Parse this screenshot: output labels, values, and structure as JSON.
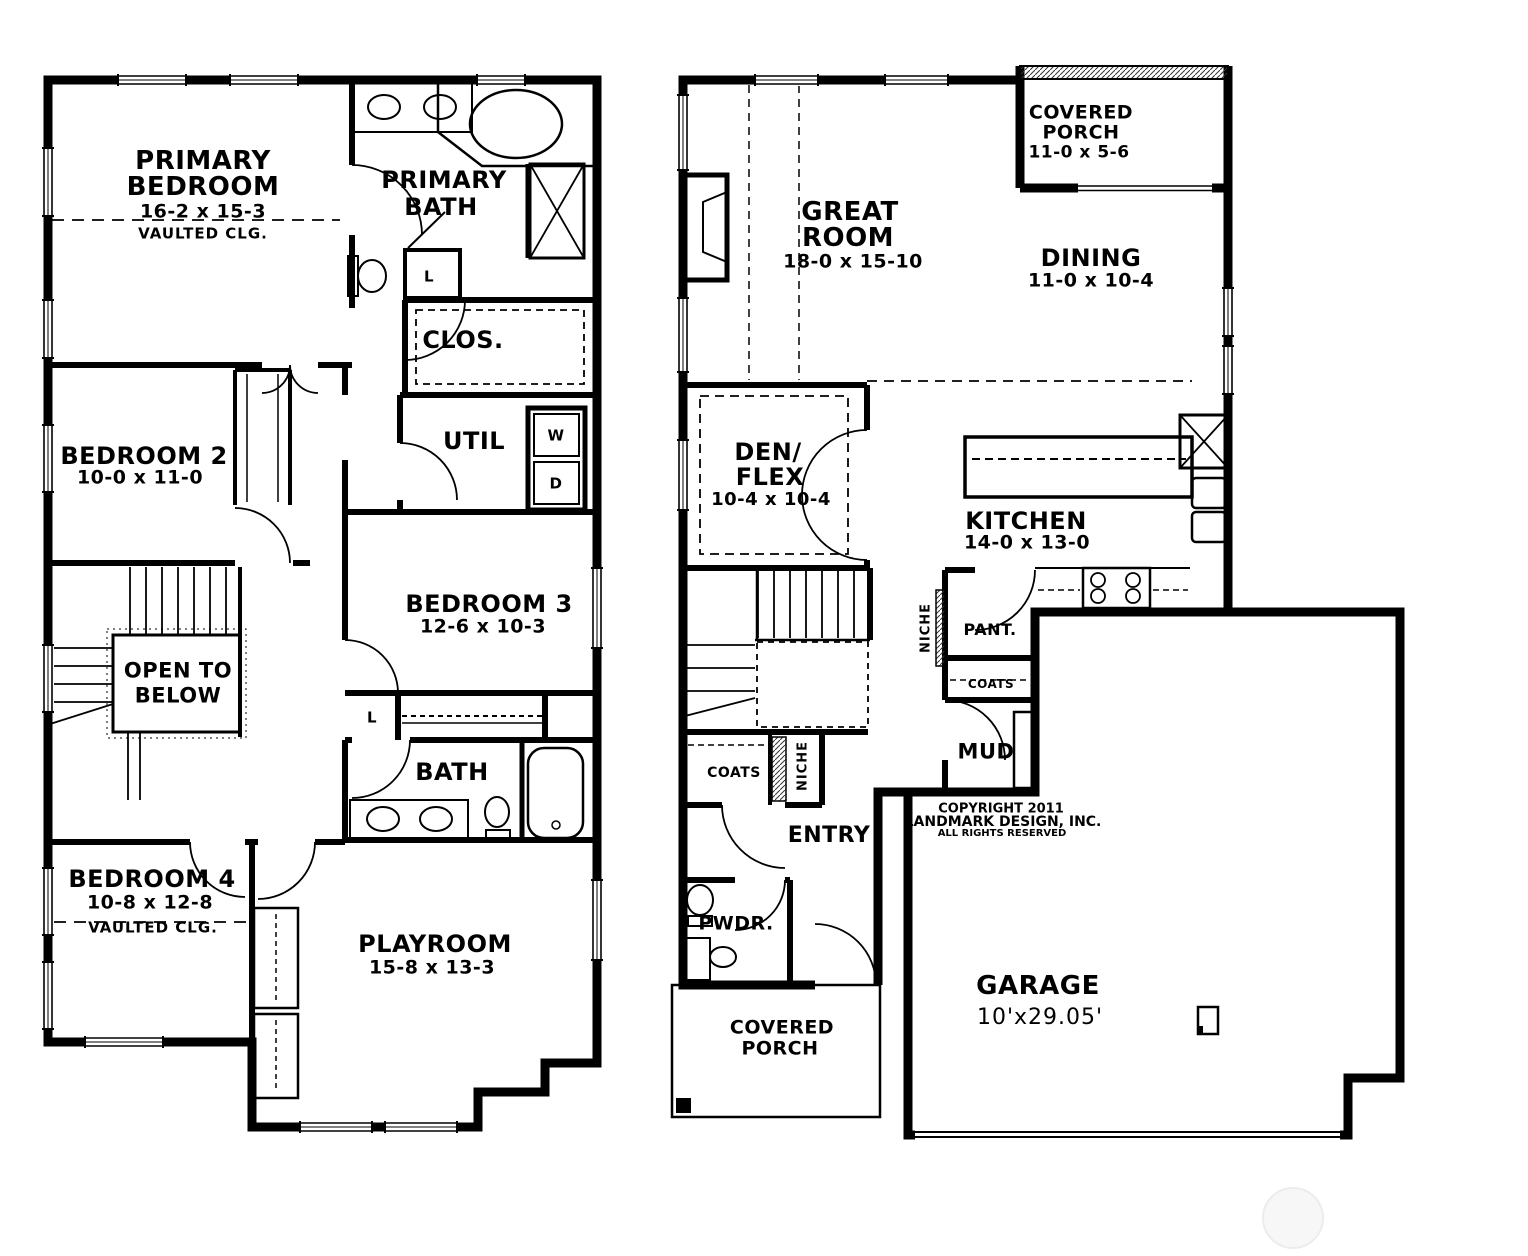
{
  "meta": {
    "ink_color": "#000000",
    "background_color": "#ffffff",
    "watermark_color": "#ececec",
    "drawing_type": "two-story house floor plan"
  },
  "plan": {
    "upper": {
      "primary_bedroom": {
        "l1": "PRIMARY",
        "l2": "BEDROOM",
        "dims": "16-2 x 15-3",
        "ceiling": "VAULTED CLG."
      },
      "primary_bath": {
        "l1": "PRIMARY",
        "l2": "BATH"
      },
      "closet": "CLOS.",
      "util": "UTIL",
      "washer": "W",
      "dryer": "D",
      "linen_primary": "L",
      "linen_hall": "L",
      "bedroom2": {
        "name": "BEDROOM 2",
        "dims": "10-0 x 11-0"
      },
      "bedroom3": {
        "name": "BEDROOM 3",
        "dims": "12-6 x 10-3"
      },
      "open_to_below": {
        "l1": "OPEN TO",
        "l2": "BELOW"
      },
      "bath": "BATH",
      "bedroom4": {
        "name": "BEDROOM 4",
        "dims": "10-8 x 12-8",
        "ceiling": "VAULTED CLG."
      },
      "playroom": {
        "name": "PLAYROOM",
        "dims": "15-8 x 13-3"
      }
    },
    "main": {
      "covered_porch_rear": {
        "l1": "COVERED",
        "l2": "PORCH",
        "dims": "11-0 x 5-6"
      },
      "great_room": {
        "l1": "GREAT",
        "l2": "ROOM",
        "dims": "18-0 x 15-10"
      },
      "dining": {
        "name": "DINING",
        "dims": "11-0 x 10-4"
      },
      "den_flex": {
        "l1": "DEN/",
        "l2": "FLEX",
        "dims": "10-4 x 10-4"
      },
      "kitchen": {
        "name": "KITCHEN",
        "dims": "14-0 x 13-0"
      },
      "niche_kitchen": "NICHE",
      "pantry": "PANT.",
      "coats_kitchen": "COATS",
      "mud": "MUD",
      "coats_entry": "COATS",
      "niche_entry": "NICHE",
      "entry": "ENTRY",
      "powder": "PWDR.",
      "covered_porch_front": {
        "l1": "COVERED",
        "l2": "PORCH"
      },
      "garage": {
        "name": "GARAGE",
        "dims": "10'x29.05'"
      }
    }
  },
  "copyright": {
    "l1": "COPYRIGHT 2011",
    "l2": "LANDMARK DESIGN, INC.",
    "l3": "ALL RIGHTS RESERVED"
  }
}
